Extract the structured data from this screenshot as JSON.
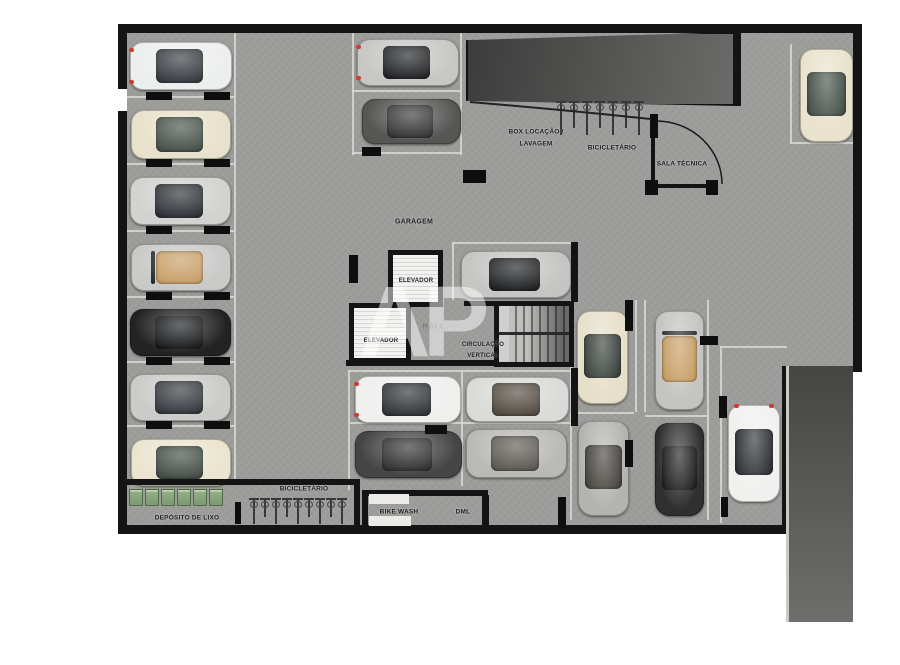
{
  "floorplan": {
    "watermark": "AP",
    "area_labels": {
      "garagem": "GARAGEM",
      "elevator1": "ELEVADOR",
      "elevator2": "ELEVADOR",
      "hall": "HALL",
      "circulacao_line1": "CIRCULAÇÃO",
      "circulacao_line2": "VERTICAL",
      "box_line1": "BOX LOCAÇÃO /",
      "box_line2": "LAVAGEM",
      "bicicletario_top": "BICICLETÁRIO",
      "sala_tecnica": "SALA TÉCNICA",
      "bicicletario_bottom": "BICICLETÁRIO",
      "bike_wash": "BIKE WASH",
      "dml": "DML",
      "deposito": "DEPÓSITO DE LIXO"
    },
    "colors": {
      "floor": "#9c9c9a",
      "wall": "#141414",
      "ramp": "#4c4c4a",
      "parking_line": "#d8d8d3",
      "bin_green": "#7d9a74"
    },
    "cars": [
      {
        "x": 130,
        "y": 42,
        "w": 102,
        "h": 48,
        "body": "#edefee",
        "glass": "#2c3036",
        "tail": "left"
      },
      {
        "x": 131,
        "y": 110,
        "w": 100,
        "h": 49,
        "body": "#e8e1cb",
        "glass": "#3c4840"
      },
      {
        "x": 130,
        "y": 177,
        "w": 101,
        "h": 48,
        "body": "#d2d2d0",
        "glass": "#22262b"
      },
      {
        "x": 131,
        "y": 244,
        "w": 100,
        "h": 47,
        "body": "#c9cac8",
        "glass": "#c59a5f",
        "open": true
      },
      {
        "x": 130,
        "y": 309,
        "w": 101,
        "h": 47,
        "body": "#232323",
        "glass": "#0f1113"
      },
      {
        "x": 130,
        "y": 374,
        "w": 101,
        "h": 47,
        "body": "#cbcbc9",
        "glass": "#2a2e33"
      },
      {
        "x": 131,
        "y": 439,
        "w": 100,
        "h": 47,
        "body": "#ebe4d0",
        "glass": "#39423c"
      },
      {
        "x": 357,
        "y": 39,
        "w": 102,
        "h": 47,
        "body": "#c7c7c5",
        "glass": "#16181b",
        "tail": "left"
      },
      {
        "x": 362,
        "y": 99,
        "w": 99,
        "h": 45,
        "body": "#565654",
        "glass": "#2e2e2e"
      },
      {
        "x": 800,
        "y": 49,
        "w": 53,
        "h": 93,
        "body": "#e9e2cc",
        "glass": "#3e4a42"
      },
      {
        "x": 461,
        "y": 251,
        "w": 110,
        "h": 47,
        "body": "#c5c5c3",
        "glass": "#131517"
      },
      {
        "x": 355,
        "y": 376,
        "w": 106,
        "h": 47,
        "body": "#eff0ee",
        "glass": "#24272c",
        "tail": "left"
      },
      {
        "x": 466,
        "y": 377,
        "w": 103,
        "h": 45,
        "body": "#dadad8",
        "glass": "#4a4238"
      },
      {
        "x": 355,
        "y": 431,
        "w": 107,
        "h": 47,
        "body": "#454545",
        "glass": "#282828"
      },
      {
        "x": 466,
        "y": 429,
        "w": 101,
        "h": 49,
        "body": "#b9b9b7",
        "glass": "#55504a"
      },
      {
        "x": 577,
        "y": 311,
        "w": 51,
        "h": 93,
        "body": "#e6dfc9",
        "glass": "#333b35"
      },
      {
        "x": 655,
        "y": 311,
        "w": 49,
        "h": 99,
        "body": "#c4c4c2",
        "glass": "#c59a5f",
        "open": true
      },
      {
        "x": 578,
        "y": 421,
        "w": 51,
        "h": 95,
        "body": "#b3b3b1",
        "glass": "#413d38"
      },
      {
        "x": 655,
        "y": 423,
        "w": 49,
        "h": 93,
        "body": "#2f2f2f",
        "glass": "#181818"
      },
      {
        "x": 728,
        "y": 405,
        "w": 52,
        "h": 97,
        "body": "#f0f1ef",
        "glass": "#26292d",
        "tail": "top"
      }
    ],
    "pillars": [
      {
        "x": 349,
        "y": 255,
        "w": 9,
        "h": 28
      },
      {
        "x": 463,
        "y": 170,
        "w": 23,
        "h": 13
      },
      {
        "x": 362,
        "y": 147,
        "w": 19,
        "h": 9
      },
      {
        "x": 425,
        "y": 425,
        "w": 22,
        "h": 9
      },
      {
        "x": 625,
        "y": 300,
        "w": 8,
        "h": 31
      },
      {
        "x": 625,
        "y": 440,
        "w": 8,
        "h": 27
      },
      {
        "x": 719,
        "y": 396,
        "w": 8,
        "h": 22
      },
      {
        "x": 721,
        "y": 497,
        "w": 7,
        "h": 20
      },
      {
        "x": 700,
        "y": 336,
        "w": 18,
        "h": 9
      },
      {
        "x": 650,
        "y": 114,
        "w": 8,
        "h": 24
      },
      {
        "x": 645,
        "y": 180,
        "w": 13,
        "h": 15
      },
      {
        "x": 706,
        "y": 180,
        "w": 12,
        "h": 15
      },
      {
        "x": 235,
        "y": 502,
        "w": 6,
        "h": 22
      },
      {
        "x": 558,
        "y": 497,
        "w": 8,
        "h": 31
      },
      {
        "x": 146,
        "y": 92,
        "w": 26,
        "h": 8
      },
      {
        "x": 204,
        "y": 92,
        "w": 26,
        "h": 8
      },
      {
        "x": 146,
        "y": 159,
        "w": 26,
        "h": 8
      },
      {
        "x": 204,
        "y": 159,
        "w": 26,
        "h": 8
      },
      {
        "x": 146,
        "y": 226,
        "w": 26,
        "h": 8
      },
      {
        "x": 204,
        "y": 226,
        "w": 26,
        "h": 8
      },
      {
        "x": 146,
        "y": 292,
        "w": 26,
        "h": 8
      },
      {
        "x": 204,
        "y": 292,
        "w": 26,
        "h": 8
      },
      {
        "x": 146,
        "y": 357,
        "w": 26,
        "h": 8
      },
      {
        "x": 204,
        "y": 357,
        "w": 26,
        "h": 8
      },
      {
        "x": 146,
        "y": 421,
        "w": 26,
        "h": 8
      },
      {
        "x": 204,
        "y": 421,
        "w": 26,
        "h": 8
      }
    ],
    "equipment": {
      "trash_bins": {
        "count": 6
      },
      "bike_racks": {
        "top_count": 7,
        "bottom_count": 9
      }
    }
  }
}
